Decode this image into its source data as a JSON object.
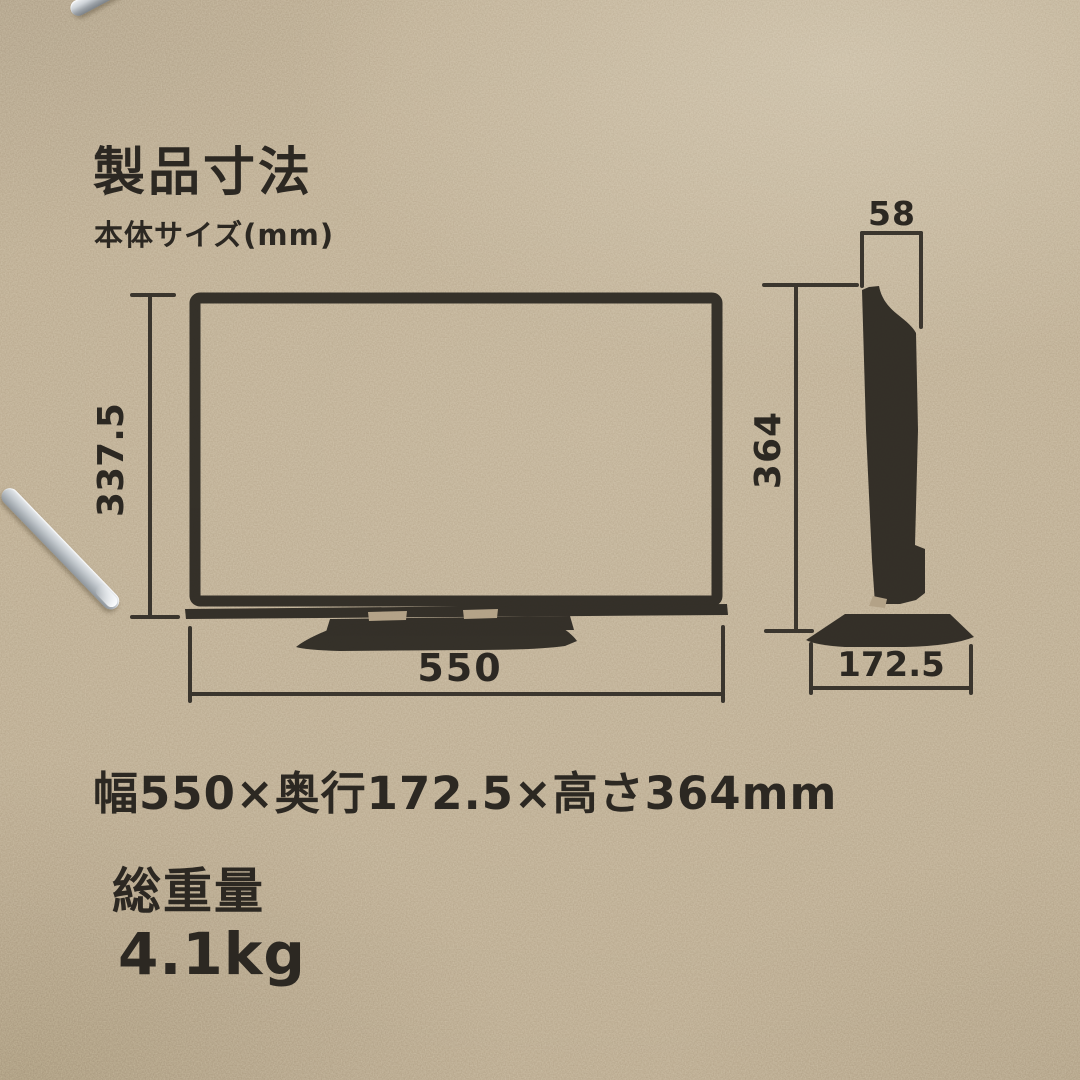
{
  "page": {
    "title": "製品寸法",
    "subtitle": "本体サイズ(mm)"
  },
  "diagram": {
    "unit": "mm",
    "front_view": {
      "height_mm": "337.5",
      "width_mm": "550"
    },
    "side_view": {
      "top_depth_mm": "58",
      "height_mm": "364",
      "base_depth_mm": "172.5"
    }
  },
  "specs": {
    "size_line": "幅550×奥行172.5×高さ364mm",
    "weight_label": "総重量",
    "weight_value": "4.1kg"
  },
  "colors": {
    "cardboard": "#b3a287",
    "ink": "#2c2822",
    "staple": "#c9ccd1"
  }
}
